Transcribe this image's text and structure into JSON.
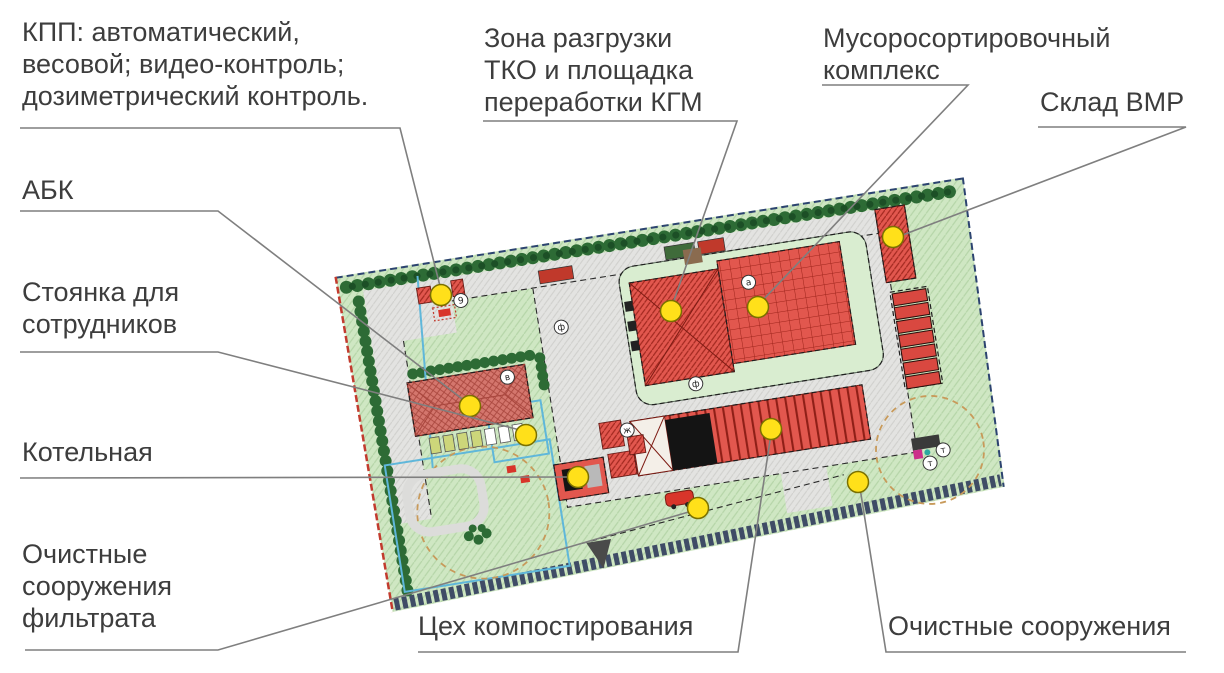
{
  "figure": {
    "kind": "site-plan-with-callouts",
    "description": "Генплан мусоросортировочного комплекса с выносными подписями"
  },
  "colors": {
    "site_green": "#cfe7c3",
    "green_hatch": "#b5d5a8",
    "platform_green": "#d9edd0",
    "road_gray": "#e3e3e1",
    "building_red": "#e2574e",
    "building_red_dark": "#9e241b",
    "abk_pink": "#d4766d",
    "tree_green": "#2d6b35",
    "boundary_red": "#c23b2e",
    "boundary_navy": "#2c4370",
    "berm_slate": "#3f4c66",
    "cyan_line": "#5fb7da",
    "tan_dash": "#c89a5a",
    "marker_yellow": "#ffe01a",
    "leader_gray": "#7f7f7f",
    "label_text": "#3d3d3d"
  },
  "callouts": [
    {
      "id": "kpp",
      "lines": [
        "КПП: автоматический,",
        "весовой; видео-контроль;",
        "дозиметрический контроль."
      ],
      "tx": 22,
      "ty": 16,
      "path": [
        [
          20,
          128
        ],
        [
          400,
          128
        ],
        [
          441,
          290
        ]
      ],
      "dot": [
        441,
        295
      ]
    },
    {
      "id": "zona-razgruzki",
      "lines": [
        "Зона разгрузки",
        "ТКО и площадка",
        "переработки КГМ"
      ],
      "tx": 484,
      "ty": 22,
      "path": [
        [
          483,
          121
        ],
        [
          737,
          121
        ],
        [
          672,
          306
        ]
      ],
      "dot": [
        671,
        311
      ]
    },
    {
      "id": "musorosortirovochny-kompleks",
      "lines": [
        "Мусоросортировочный",
        "комплекс"
      ],
      "tx": 823,
      "ty": 22,
      "path": [
        [
          822,
          85
        ],
        [
          968,
          85
        ],
        [
          760,
          303
        ]
      ],
      "dot": [
        758,
        307
      ]
    },
    {
      "id": "sklad-vmr",
      "lines": [
        "Склад ВМР"
      ],
      "tx": 1040,
      "ty": 86,
      "path": [
        [
          1038,
          127
        ],
        [
          1186,
          127
        ],
        [
          900,
          236
        ]
      ],
      "dot": [
        893,
        237
      ]
    },
    {
      "id": "abk",
      "lines": [
        "АБК"
      ],
      "tx": 22,
      "ty": 174,
      "path": [
        [
          20,
          211
        ],
        [
          218,
          211
        ],
        [
          465,
          401
        ]
      ],
      "dot": [
        470,
        406
      ]
    },
    {
      "id": "stoyanka",
      "lines": [
        "Стоянка для",
        "сотрудников"
      ],
      "tx": 22,
      "ty": 276,
      "path": [
        [
          20,
          352
        ],
        [
          218,
          352
        ],
        [
          520,
          430
        ]
      ],
      "dot": [
        526,
        435
      ]
    },
    {
      "id": "kotelnaya",
      "lines": [
        "Котельная"
      ],
      "tx": 22,
      "ty": 436,
      "path": [
        [
          20,
          478
        ],
        [
          571,
          477
        ]
      ],
      "dot": [
        578,
        477
      ]
    },
    {
      "id": "ochistnye-filtrata",
      "lines": [
        "Очистные",
        "сооружения",
        "фильтрата"
      ],
      "tx": 22,
      "ty": 538,
      "path": [
        [
          25,
          650
        ],
        [
          218,
          650
        ],
        [
          692,
          511
        ]
      ],
      "dot": [
        698,
        508
      ]
    },
    {
      "id": "ceh-kompostirovaniya",
      "lines": [
        "Цех компостирования"
      ],
      "tx": 418,
      "ty": 610,
      "path": [
        [
          418,
          652
        ],
        [
          738,
          652
        ],
        [
          771,
          434
        ]
      ],
      "dot": [
        771,
        429
      ]
    },
    {
      "id": "ochistnye-sooruzheniya",
      "lines": [
        "Очистные сооружения"
      ],
      "tx": 888,
      "ty": 610,
      "path": [
        [
          1186,
          652
        ],
        [
          886,
          652
        ],
        [
          860,
          488
        ]
      ],
      "dot": [
        858,
        482
      ]
    }
  ]
}
